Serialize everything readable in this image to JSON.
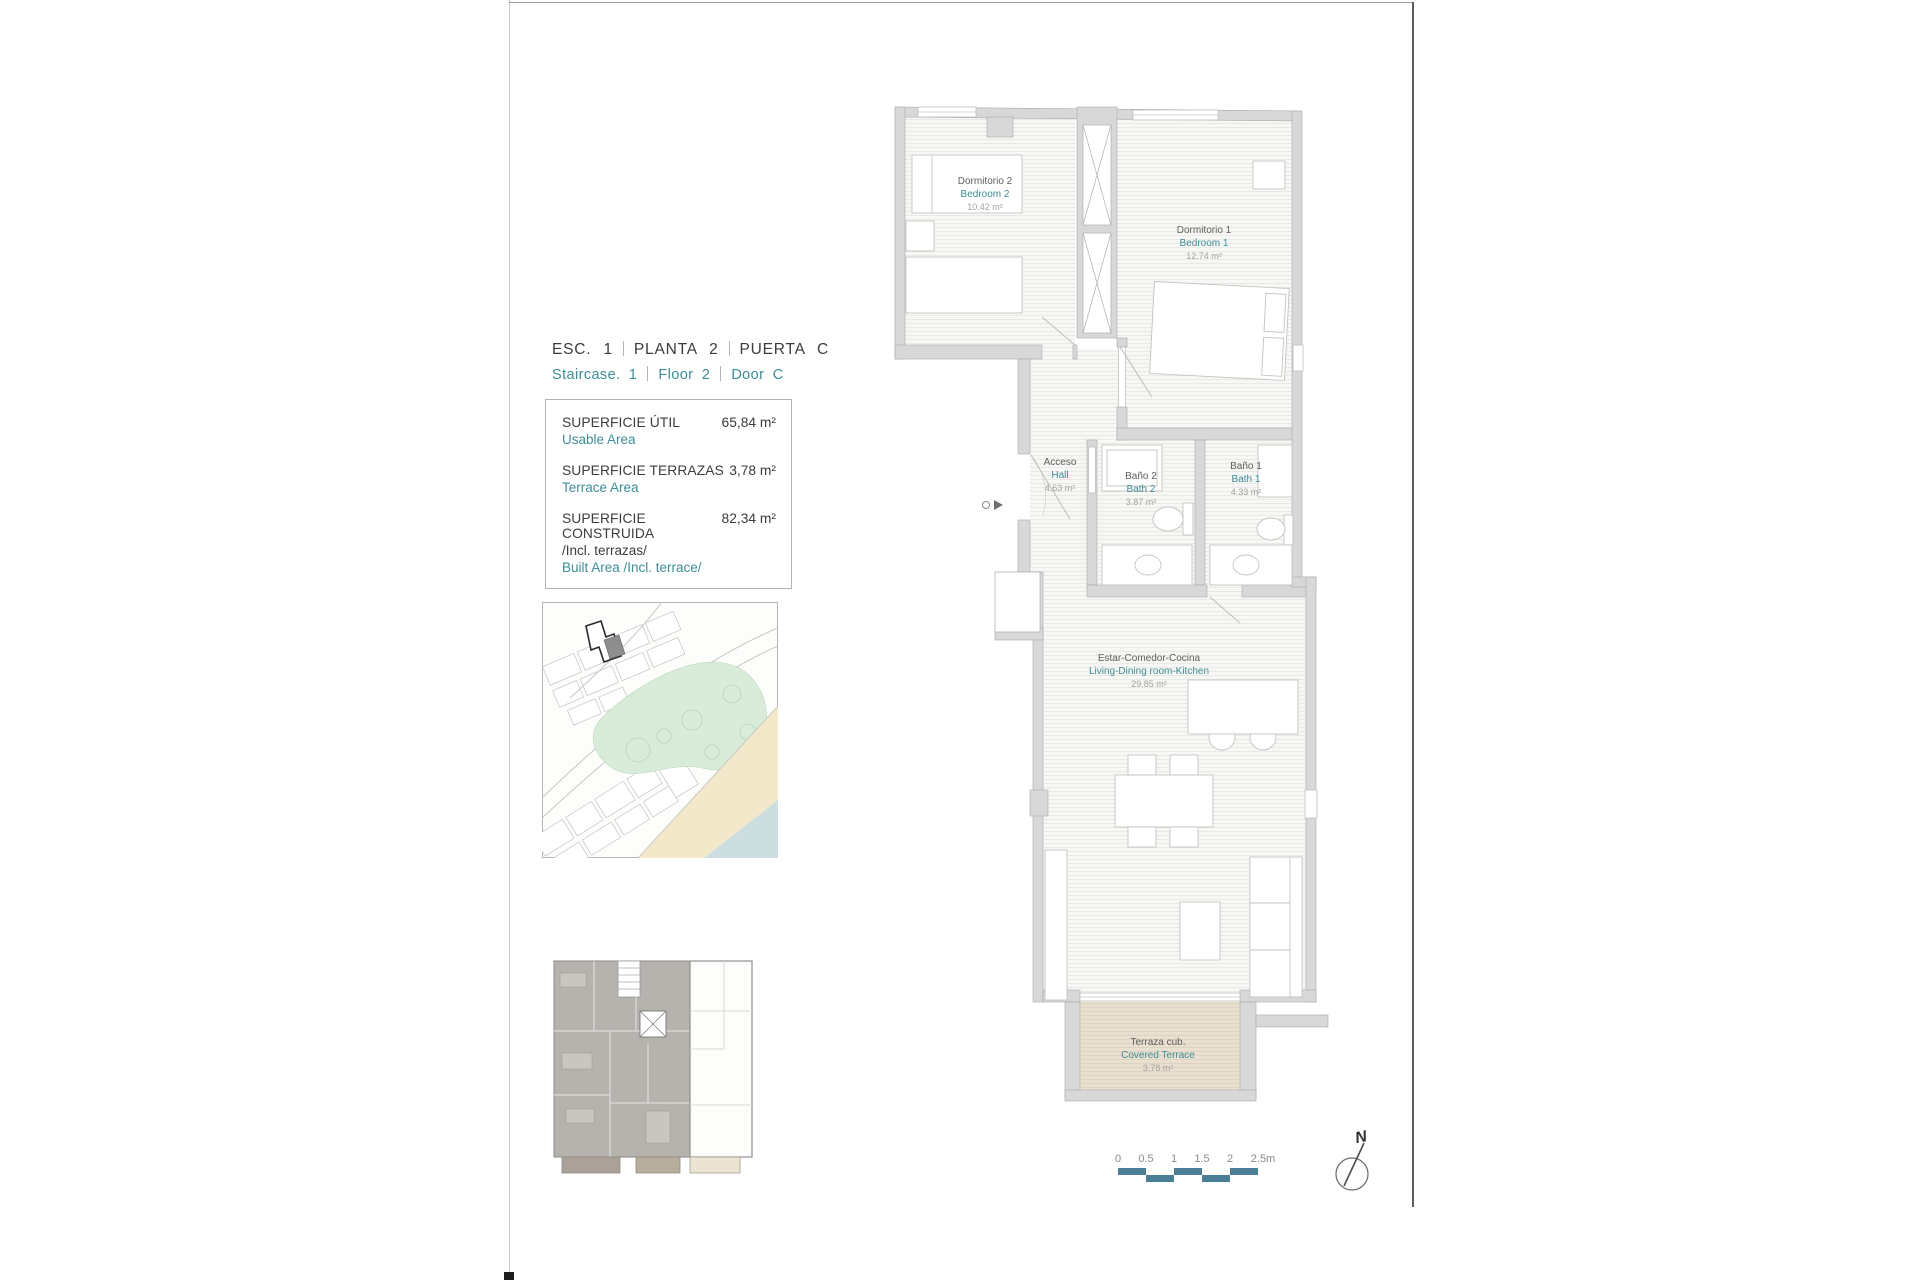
{
  "page": {
    "header": {
      "line1": [
        "ESC. 1",
        "PLANTA  2",
        "PUERTA C"
      ],
      "line2": [
        "Staircase. 1",
        "Floor  2",
        "Door C"
      ]
    },
    "areas": [
      {
        "label": "SUPERFICIE ÚTIL",
        "value": "65,84 m²",
        "label_en": "Usable Area"
      },
      {
        "label": "SUPERFICIE TERRAZAS",
        "value": "3,78 m²",
        "label_en": "Terrace Area"
      },
      {
        "label": "SUPERFICIE CONSTRUIDA",
        "sublabel": "/Incl. terrazas/",
        "value": "82,34 m²",
        "label_en": "Built Area /Incl. terrace/"
      }
    ],
    "rooms": {
      "bedroom2": {
        "es": "Dormitorio 2",
        "en": "Bedroom 2",
        "area": "10.42 m²"
      },
      "bedroom1": {
        "es": "Dormitorio 1",
        "en": "Bedroom 1",
        "area": "12.74 m²"
      },
      "hall": {
        "es": "Acceso",
        "en": "Hall",
        "area": "4.63 m²"
      },
      "bath2": {
        "es": "Baño 2",
        "en": "Bath 2",
        "area": "3.87 m²"
      },
      "bath1": {
        "es": "Baño 1",
        "en": "Bath 1",
        "area": "4.33 m²"
      },
      "living": {
        "es": "Estar-Comedor-Cocina",
        "en": "Living-Dining room-Kitchen",
        "area": "29.85 m²"
      },
      "terrace": {
        "es": "Terraza cub.",
        "en": "Covered Terrace",
        "area": "3.78 m²"
      }
    },
    "scalebar": {
      "labels": [
        "0",
        "0.5",
        "1",
        "1.5",
        "2",
        "2.5m"
      ]
    },
    "north_label": "N",
    "colors": {
      "teal": "#3E8D97",
      "scale_bar": "#4A7F96",
      "wall": "#D8D8D8",
      "terrace_fill": "#E9E0D1",
      "park": "#D9ECD9",
      "sand": "#F4E8CA",
      "water": "#CCDEE0",
      "unit_gray": "#B6B3AE"
    }
  }
}
